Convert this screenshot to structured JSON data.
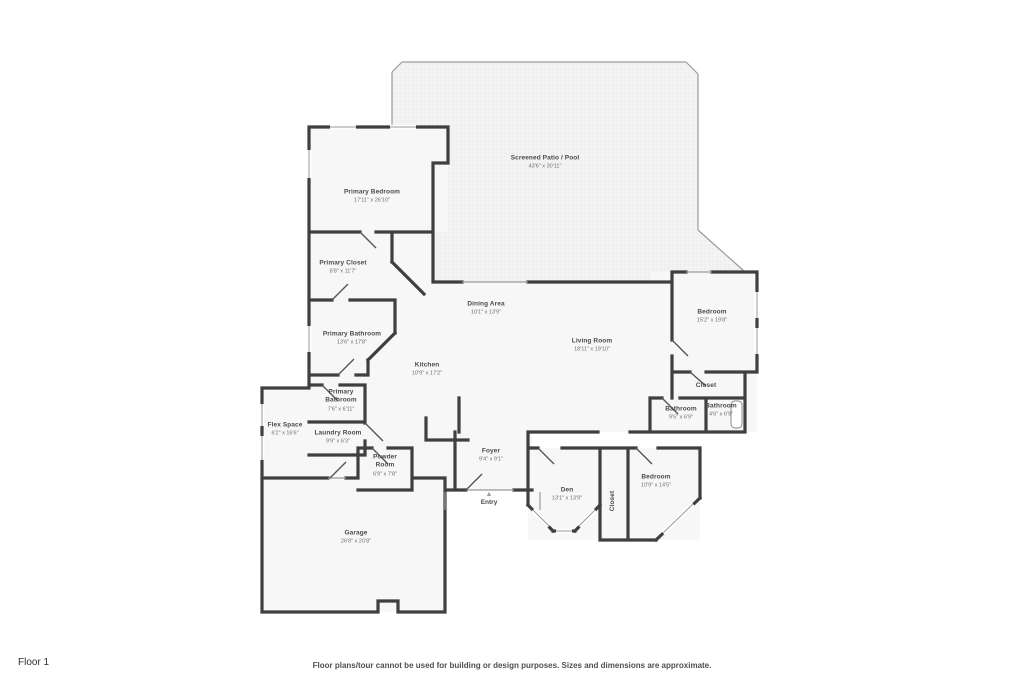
{
  "page": {
    "floor_label": "Floor 1",
    "disclaimer": "Floor plans/tour cannot be used for building or design purposes. Sizes and dimensions are approximate."
  },
  "rooms": {
    "screened_patio": {
      "name": "Screened Patio / Pool",
      "dims": "43'6\" x 30'11\""
    },
    "primary_bedroom": {
      "name": "Primary Bedroom",
      "dims": "17'11\" x 26'10\""
    },
    "primary_closet": {
      "name": "Primary Closet",
      "dims": "8'8\" x 11'7\""
    },
    "primary_bathroom": {
      "name": "Primary Bathroom",
      "dims": "13'6\" x 17'8\""
    },
    "primary_bathroom_2": {
      "name": "Primary Bathroom",
      "dims": "7'6\" x 6'11\""
    },
    "dining_area": {
      "name": "Dining Area",
      "dims": "10'1\" x 13'9\""
    },
    "kitchen": {
      "name": "Kitchen",
      "dims": "10'9\" x 17'2\""
    },
    "living_room": {
      "name": "Living Room",
      "dims": "18'11\" x 19'10\""
    },
    "bedroom_right": {
      "name": "Bedroom",
      "dims": "15'2\" x 19'8\""
    },
    "closet_right": {
      "name": "Closet"
    },
    "bathroom_1": {
      "name": "Bathroom",
      "dims": "9'5\" x 6'9\""
    },
    "bathroom_2": {
      "name": "Bathroom",
      "dims": "4'6\" x 6'9\""
    },
    "flex_space": {
      "name": "Flex Space",
      "dims": "6'2\" x 16'6\""
    },
    "laundry_room": {
      "name": "Laundry Room",
      "dims": "9'9\" x 6'3\""
    },
    "powder_room": {
      "name": "Powder Room",
      "dims": "6'9\" x 7'8\""
    },
    "foyer": {
      "name": "Foyer",
      "dims": "9'4\" x 9'1\""
    },
    "den": {
      "name": "Den",
      "dims": "13'1\" x 13'9\""
    },
    "closet_bottom": {
      "name": "Closet"
    },
    "bedroom_bottom": {
      "name": "Bedroom",
      "dims": "10'9\" x 14'5\""
    },
    "garage": {
      "name": "Garage",
      "dims": "26'8\" x 20'8\""
    },
    "entry": {
      "name": "Entry"
    }
  }
}
